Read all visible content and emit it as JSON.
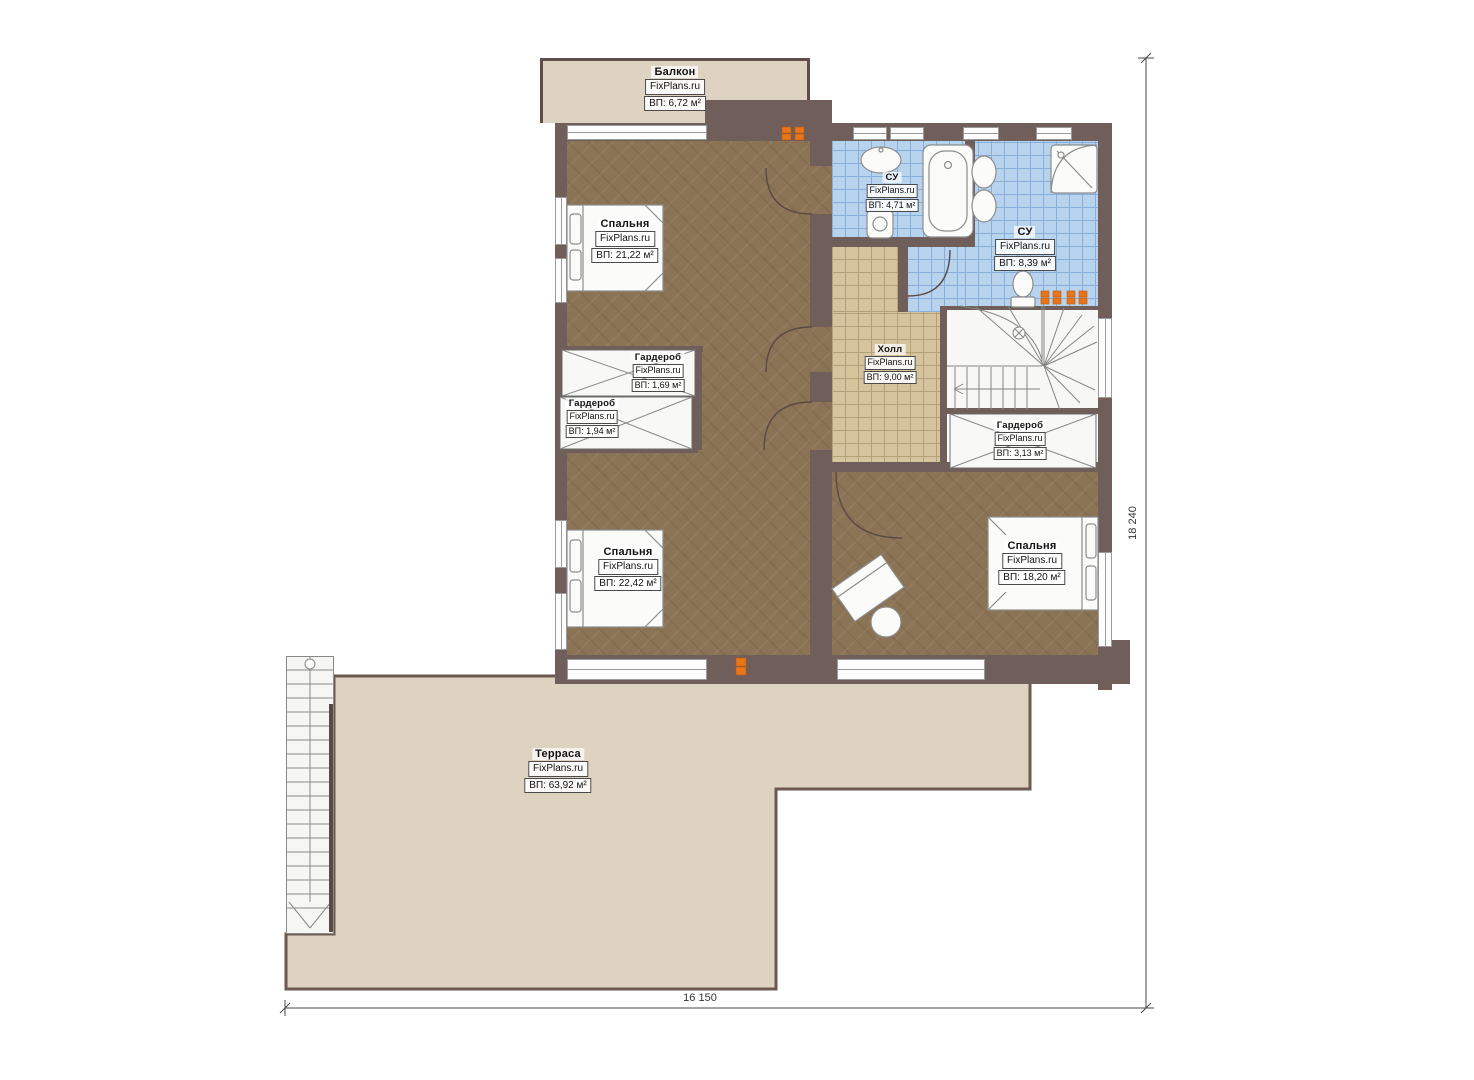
{
  "rooms": [
    {
      "name": "Балкон",
      "brand": "FixPlans.ru",
      "area": "ВП: 6,72 м²"
    },
    {
      "name": "Спальня",
      "brand": "FixPlans.ru",
      "area": "ВП: 21,22 м²"
    },
    {
      "name": "СУ",
      "brand": "FixPlans.ru",
      "area": "ВП: 4,71 м²"
    },
    {
      "name": "СУ",
      "brand": "FixPlans.ru",
      "area": "ВП: 8,39 м²"
    },
    {
      "name": "Холл",
      "brand": "FixPlans.ru",
      "area": "ВП: 9,00 м²"
    },
    {
      "name": "Гардероб",
      "brand": "FixPlans.ru",
      "area": "ВП: 1,69 м²"
    },
    {
      "name": "Гардероб",
      "brand": "FixPlans.ru",
      "area": "ВП: 1,94 м²"
    },
    {
      "name": "Гардероб",
      "brand": "FixPlans.ru",
      "area": "ВП: 3,13 м²"
    },
    {
      "name": "Спальня",
      "brand": "FixPlans.ru",
      "area": "ВП: 22,42 м²"
    },
    {
      "name": "Спальня",
      "brand": "FixPlans.ru",
      "area": "ВП: 18,20 м²"
    },
    {
      "name": "Терраса",
      "brand": "FixPlans.ru",
      "area": "ВП: 63,92 м²"
    }
  ],
  "dimensions": {
    "width": "16 150",
    "height": "18 240"
  },
  "colors": {
    "wall": "#6f5e5a",
    "wood_floor": "#8b7355",
    "tile_blue": "#b7d3ee",
    "tile_tan": "#d6c49e",
    "outdoor": "#ddd3c0",
    "radiator": "#e8751a"
  }
}
